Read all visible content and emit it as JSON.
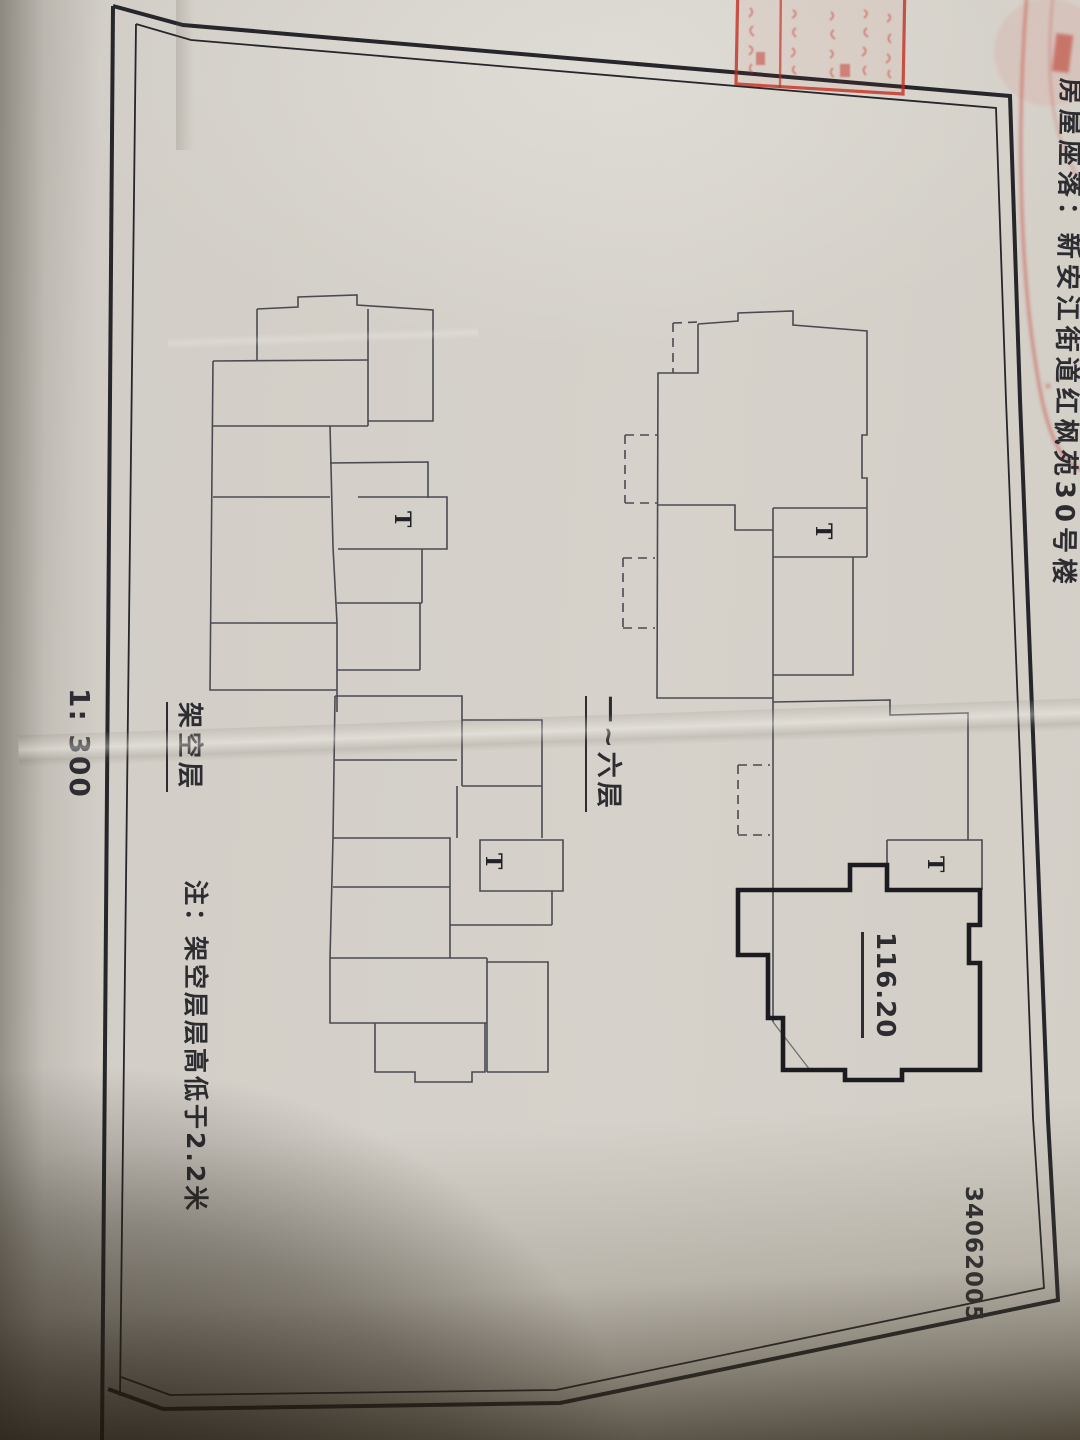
{
  "texts": {
    "property_location_title": "房屋座落：新安江街道红枫苑30号楼",
    "scale": "1: 300",
    "stilt_floor": "架空层",
    "floors_one_to_six": "一~六层",
    "note": "注：架空层层高低于2.2米",
    "area_value": "116.20",
    "elevator_mark": "T",
    "document_number": "34062005"
  },
  "colors": {
    "paper": "#d5d1ca",
    "ink": "#2c2c31",
    "plan_line": "#4a4a52",
    "bold_outline": "#1c1c20",
    "frame_border": "#26262b",
    "stamp_red": "#c2392b",
    "shadow_brown": "#2c2416"
  }
}
